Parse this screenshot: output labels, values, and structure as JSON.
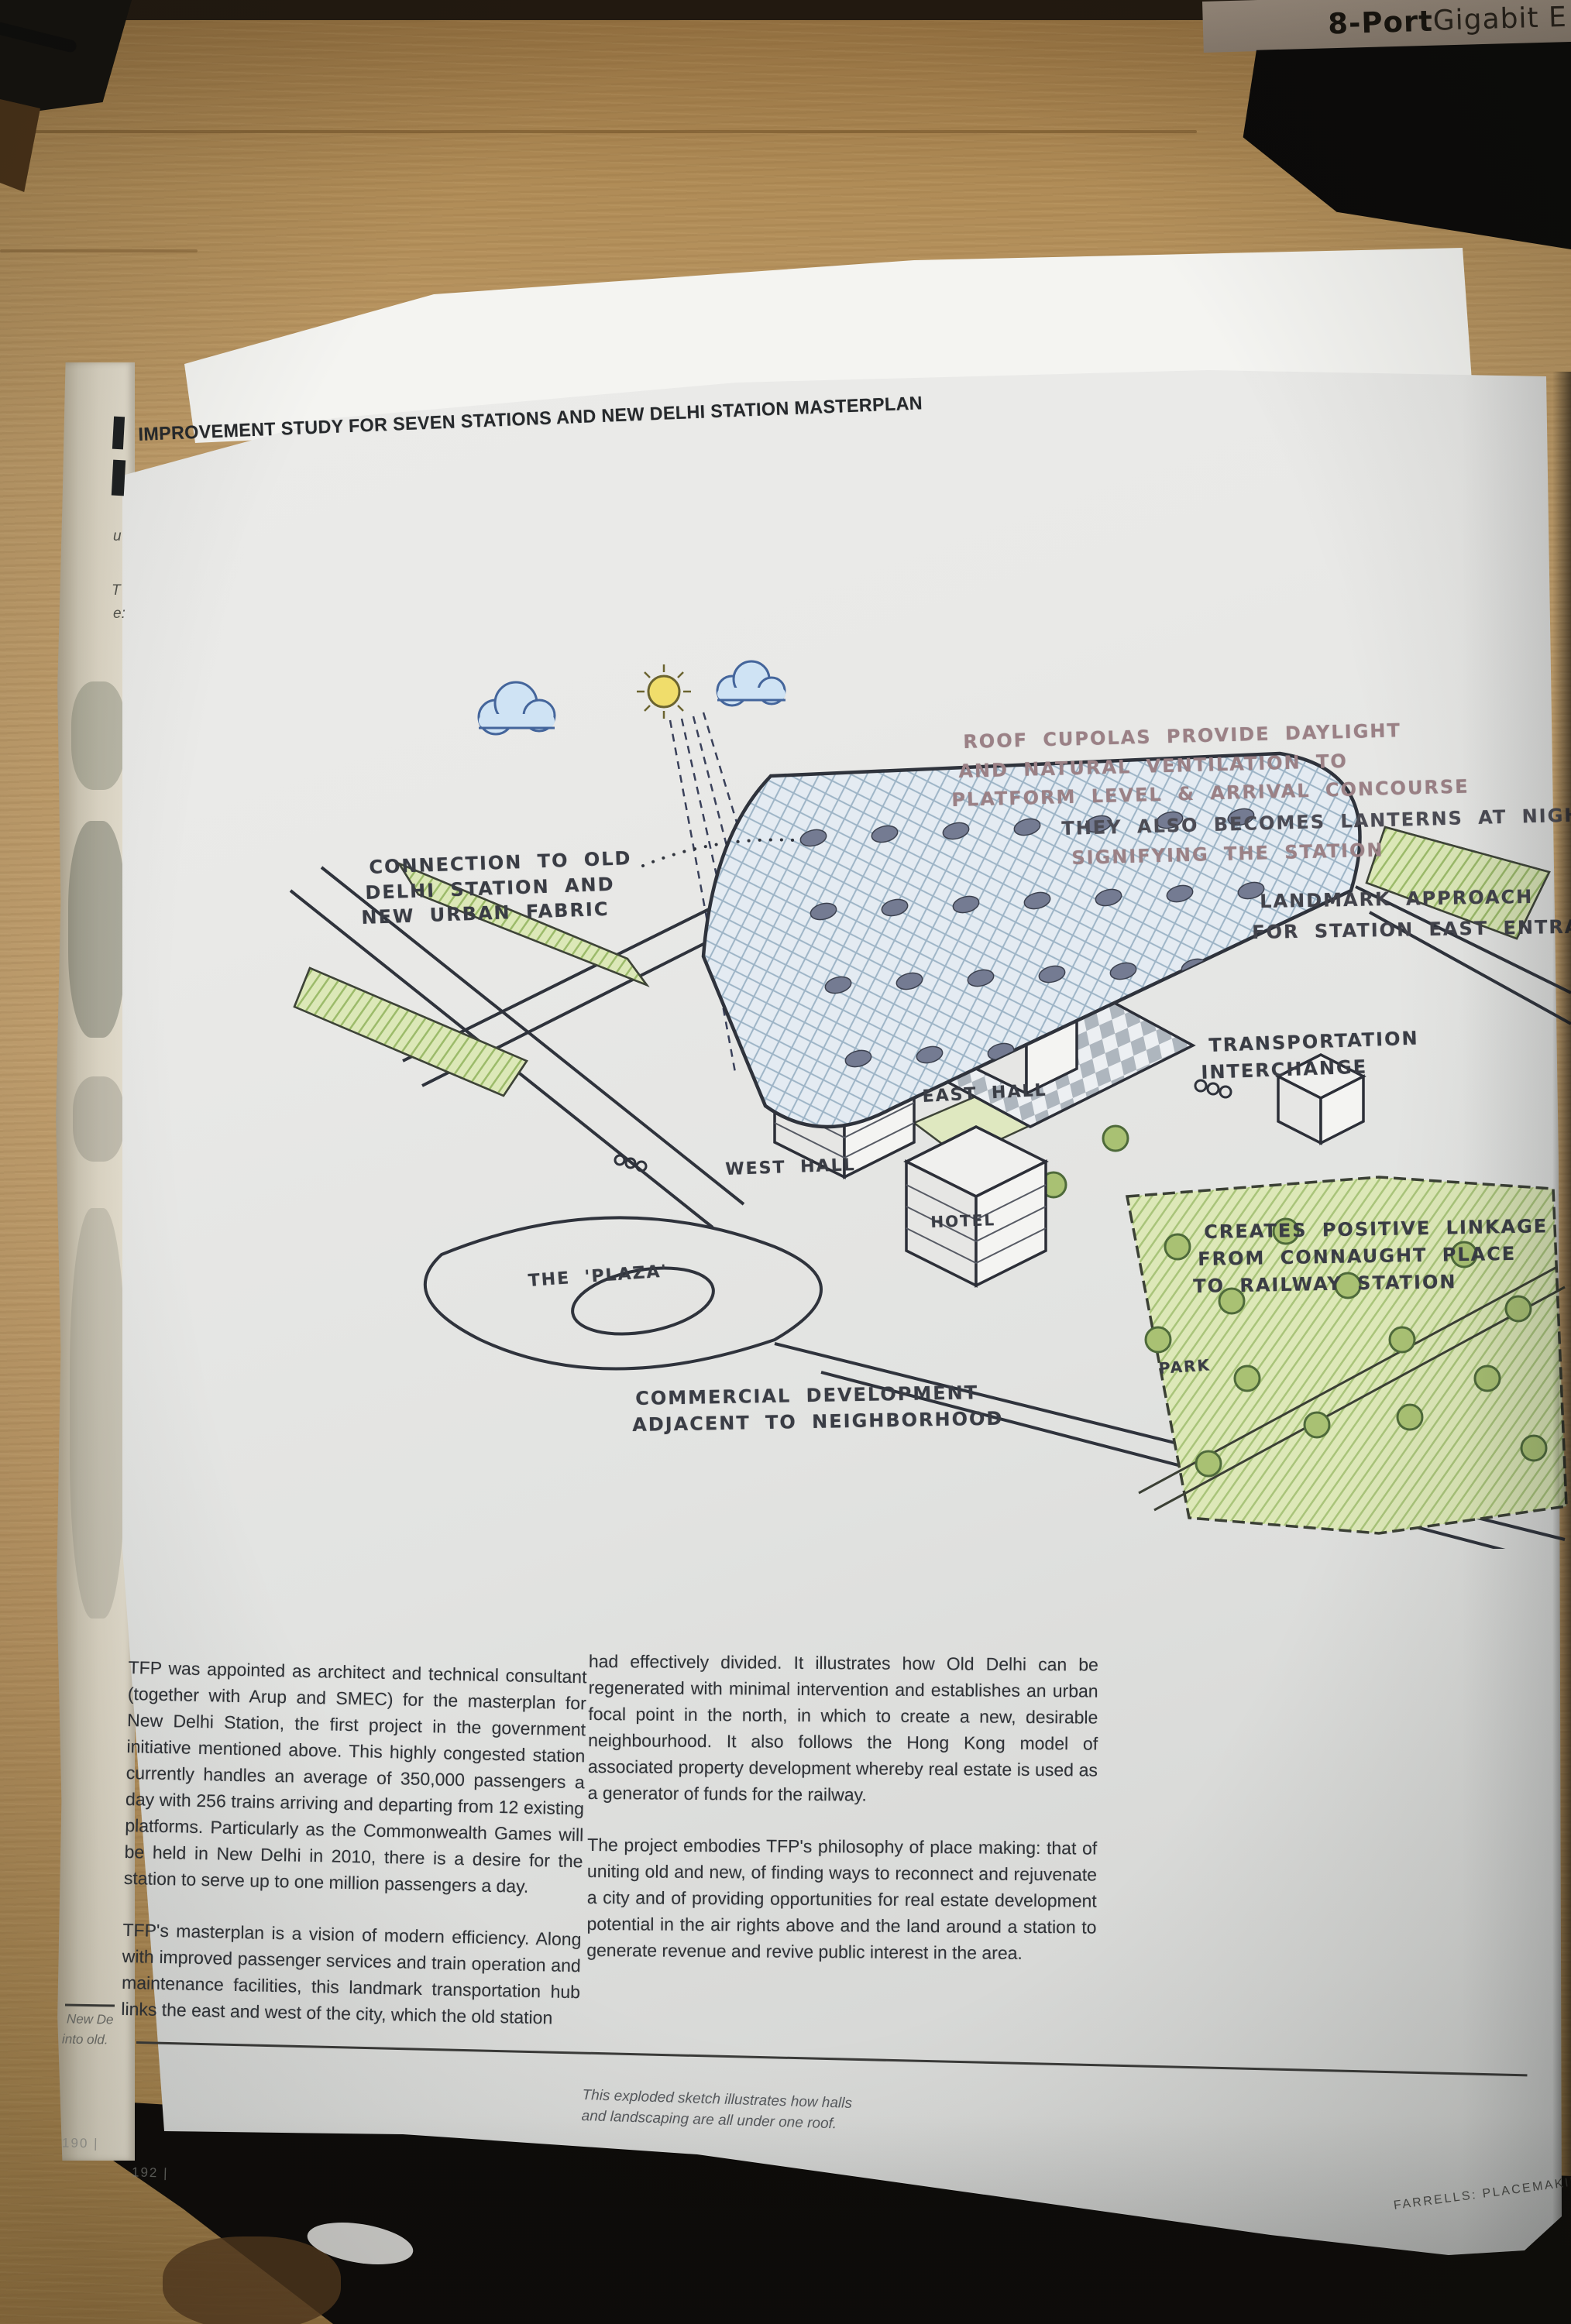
{
  "photo": {
    "switch_label_bold": "8-Port",
    "switch_label_rest": " Gigabit E"
  },
  "page": {
    "header": "IMPROVEMENT STUDY FOR SEVEN STATIONS AND NEW DELHI STATION MASTERPLAN",
    "sketch": {
      "annotations": {
        "roof": [
          "ROOF CUPOLAS PROVIDE DAYLIGHT",
          "AND NATURAL VENTILATION TO",
          "PLATFORM LEVEL & ARRIVAL CONCOURSE",
          "THEY ALSO BECOMES LANTERNS AT NIGHT",
          "SIGNIFYING THE STATION"
        ],
        "landmark": [
          "LANDMARK APPROACH",
          "FOR STATION EAST ENTRANCE"
        ],
        "connection": [
          "CONNECTION TO OLD",
          "DELHI STATION AND",
          "NEW URBAN FABRIC"
        ],
        "transport": [
          "TRANSPORTATION",
          "INTERCHANGE"
        ],
        "east_hall": "EAST HALL",
        "west_hall": "WEST HALL",
        "hotel": "HOTEL",
        "plaza": "THE 'PLAZA'",
        "commercial": [
          "COMMERCIAL DEVELOPMENT",
          "ADJACENT TO NEIGHBORHOOD"
        ],
        "linkage": [
          "CREATES POSITIVE LINKAGE",
          "FROM CONNAUGHT PLACE",
          "TO RAILWAY STATION"
        ],
        "park": "PARK"
      }
    },
    "body": {
      "left": [
        "TFP was appointed as architect and technical consultant (together with Arup and SMEC) for the masterplan for New Delhi Station, the first project in the government initiative mentioned above. This highly congested station currently handles an average of 350,000 passengers a day with 256 trains arriving and departing from 12 existing platforms. Particularly as the Commonwealth Games will be held in New Delhi in 2010, there is a desire for the station to serve up to one million passengers a day.",
        "TFP's masterplan is a vision of modern efficiency. Along with improved passenger services and train operation and maintenance facilities, this landmark transportation hub links the east and west of the city, which the old station"
      ],
      "right": [
        "had effectively divided. It illustrates how Old Delhi can be regenerated with minimal intervention and establishes an urban focal point in the north, in which to create a new, desirable neighbourhood. It also follows the Hong Kong model of associated property development whereby real estate is used as a generator of funds for the railway.",
        "The project embodies TFP's philosophy of place making: that of uniting old and new, of finding ways to reconnect and rejuvenate a city and of providing opportunities for real estate development potential in the air rights above and the land around a station to generate revenue and revive public interest in the area."
      ]
    },
    "caption": "This exploded sketch illustrates how halls and landscaping are all under one roof.",
    "margin_note": {
      "line1": "New De",
      "line2": "into old."
    },
    "page_number_under": "190 |",
    "page_number_main": "192 |",
    "footer": "FARRELLS: PLACEMAKING",
    "edge_fragments": {
      "f1": "u",
      "f2": "T",
      "f3": "e:"
    }
  },
  "palette": {
    "page": "#e8e8e6",
    "desk_wood": "#b8945f",
    "body_ink": "#2f3237",
    "annotation_ink": "#3a3d45",
    "annotation_faded": "#9b8186",
    "sketch_green": "#c9d996",
    "sketch_roof_blue": "#e4ebf2"
  }
}
